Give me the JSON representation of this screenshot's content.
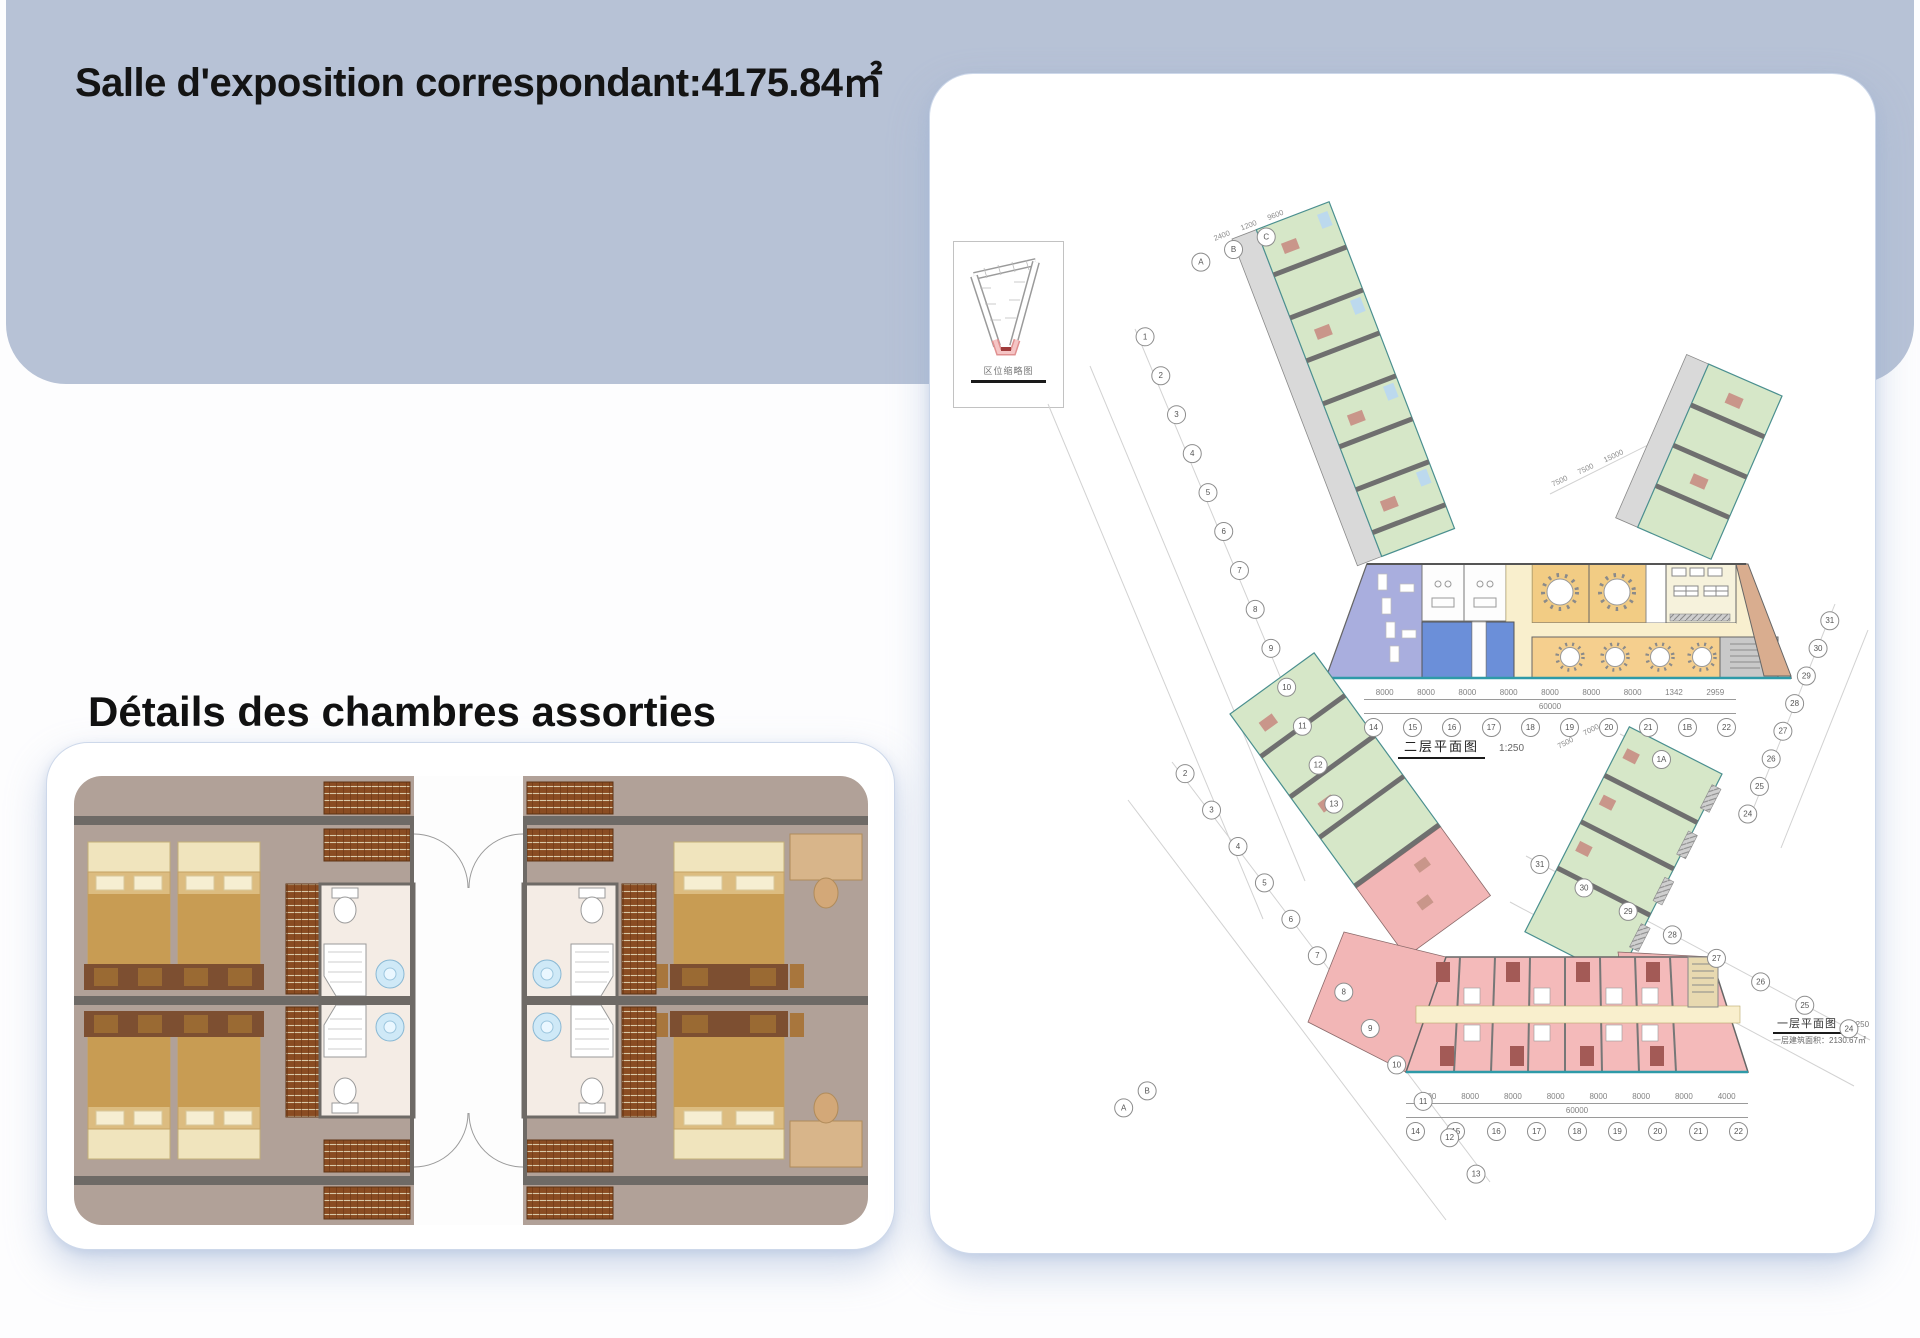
{
  "hero": {
    "title": "Salle d'exposition correspondant:4175.84㎡"
  },
  "rooms": {
    "heading": "Détails des chambres assorties"
  },
  "palette": {
    "hero_bg": "#b7c2d6",
    "card_border": "#cdd8ea",
    "green_room": "#d6e7c8",
    "pink_room": "#f4b9b9",
    "dining_yellow": "#f2cc84",
    "hall_yellow": "#f5d794",
    "kitchen_cream": "#f6f2dc",
    "corridor_cream": "#f9efcd",
    "lavender": "#a9aede",
    "blue_room": "#6b8fd9",
    "tan_room": "#d9ad8f",
    "corridor_gray": "#d9d9d9",
    "wall_gray": "#6f6b66",
    "window_teal": "#2e9aa8"
  },
  "inset": {
    "caption": "区位缩略图"
  },
  "floor2": {
    "caption": "二层平面图",
    "scale": "1:250",
    "total": "60000",
    "dims": [
      "8000",
      "8000",
      "8000",
      "8000",
      "8000",
      "8000",
      "8000",
      "1342",
      "2959"
    ],
    "bottom_axis": [
      "14",
      "15",
      "16",
      "17",
      "18",
      "19",
      "20",
      "21",
      "1B",
      "22"
    ],
    "left_axis": [
      "1",
      "2",
      "3",
      "4",
      "5",
      "6",
      "7",
      "8",
      "9",
      "10",
      "11",
      "12",
      "13"
    ],
    "top_axis": [
      "A",
      "B",
      "C"
    ],
    "top_dims": [
      "2400",
      "1200",
      "9600"
    ],
    "right_axis": [
      "31",
      "30",
      "29",
      "28",
      "27",
      "26",
      "25",
      "24"
    ],
    "wing_dims": [
      "7500",
      "7500",
      "15000"
    ]
  },
  "floor1": {
    "caption": "一层平面图",
    "scale": "1:250",
    "area_note": "一层建筑面积：2130.67㎡",
    "total": "60000",
    "dims": [
      "8000",
      "8000",
      "8000",
      "8000",
      "8000",
      "8000",
      "8000",
      "4000"
    ],
    "bottom_axis": [
      "14",
      "15",
      "16",
      "17",
      "18",
      "19",
      "20",
      "21",
      "22"
    ],
    "left_axis": [
      "2",
      "3",
      "4",
      "5",
      "6",
      "7",
      "8",
      "9",
      "10",
      "11",
      "12",
      "13"
    ],
    "right_axis": [
      "31",
      "30",
      "29",
      "28",
      "27",
      "26",
      "25",
      "24"
    ],
    "corner_axis": "1A",
    "top_axis": [
      "A",
      "B"
    ],
    "wing_dims": [
      "7500",
      "7000"
    ]
  }
}
